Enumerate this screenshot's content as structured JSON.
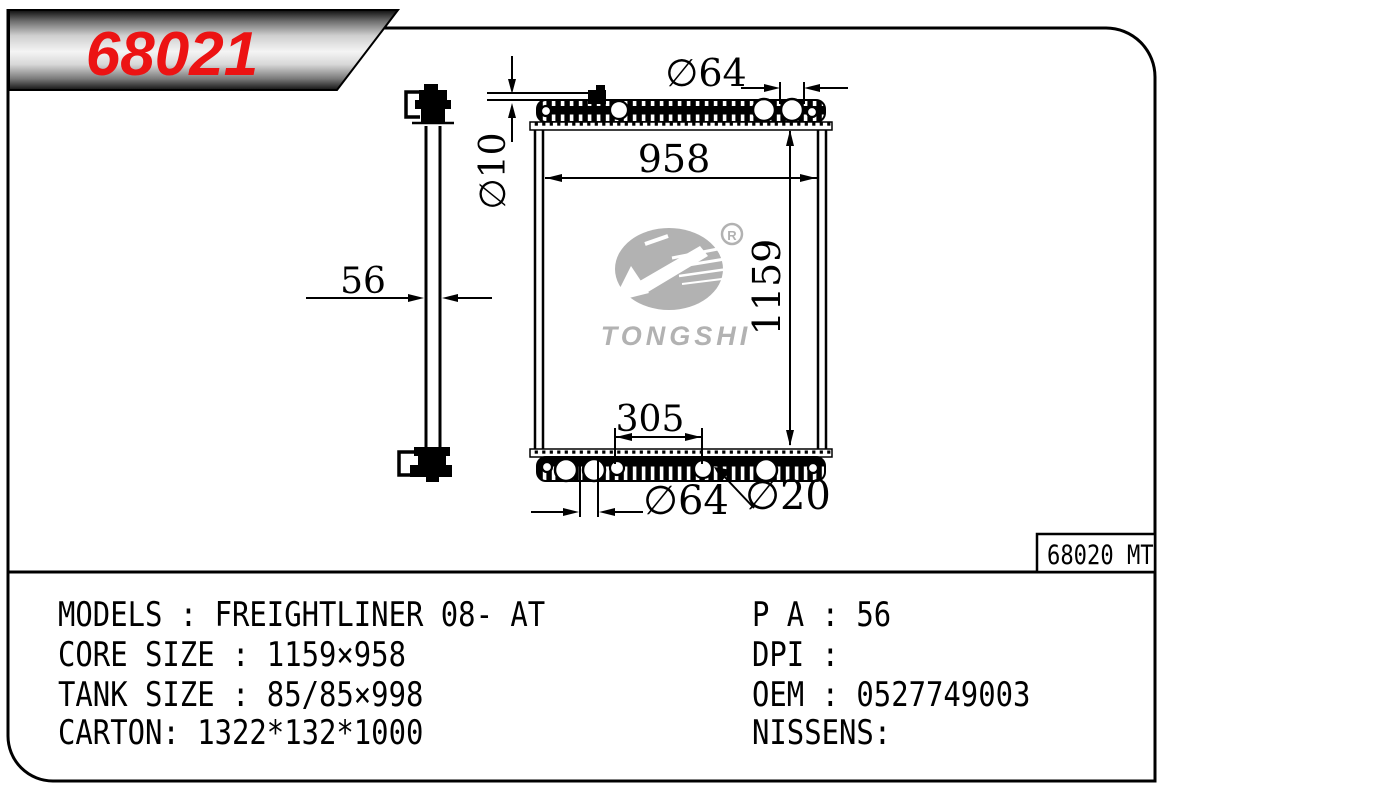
{
  "banner": {
    "part_number": "68021"
  },
  "drawing": {
    "ref_label": "68020 MT",
    "dimensions": {
      "top_hole_diameter": "∅64",
      "pipe_diameter": "∅10",
      "core_width": "958",
      "core_height": "1159",
      "depth": "56",
      "bracket_span": "305",
      "bottom_hole_diameter": "∅64",
      "drain_hole_diameter": "∅20"
    },
    "logo": {
      "brand": "TONGSHI",
      "registered_mark": "R"
    }
  },
  "specs": {
    "left": [
      "MODELS : FREIGHTLINER 08- AT",
      "CORE SIZE : 1159×958",
      "TANK SIZE : 85/85×998",
      "CARTON: 1322*132*1000"
    ],
    "right": [
      "P A : 56",
      "DPI :",
      "OEM : 0527749003",
      "NISSENS:"
    ]
  },
  "colors": {
    "part_number_red": "#ec1313",
    "logo_gray": "#b2b2b2",
    "line": "#000000"
  }
}
